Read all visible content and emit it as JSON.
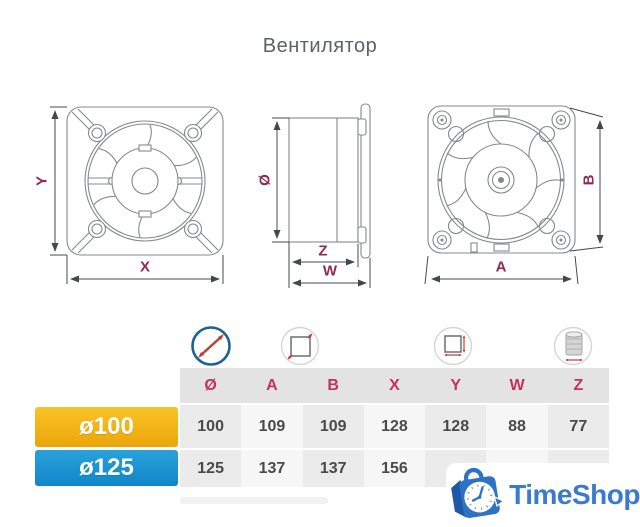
{
  "title": "Вентилятор",
  "drawings": {
    "front_view": {
      "dim_y": "Y",
      "dim_x": "X"
    },
    "side_view": {
      "dim_diameter": "Ø",
      "dim_z": "Z",
      "dim_w": "W"
    },
    "back_view": {
      "dim_b": "B",
      "dim_a": "A"
    }
  },
  "table": {
    "icon_names": [
      "diameter-icon",
      "panel-size-icon",
      "duct-panel-size-icon",
      "duct-depth-icon"
    ],
    "columns": [
      "Ø",
      "A",
      "B",
      "X",
      "Y",
      "W",
      "Z"
    ],
    "rows": [
      {
        "label": "ø100",
        "values": [
          "100",
          "109",
          "109",
          "128",
          "128",
          "88",
          "77"
        ]
      },
      {
        "label": "ø125",
        "values": [
          "125",
          "137",
          "137",
          "156",
          "",
          "",
          ""
        ]
      }
    ]
  },
  "logo": {
    "text": "TimeShop"
  },
  "colors": {
    "title_text": "#5d6266",
    "header_text": "#c5315f",
    "dim_label_text": "#8f2b52",
    "row_100_bg": "#f2b014",
    "row_125_bg": "#1a94d2",
    "header_bg": "#e3e3e3",
    "cell_dark": "#ebebeb",
    "cell_light": "#f6f6f6",
    "logo_blue": "#3b7ad3",
    "diameter_icon_ring": "#1c6391",
    "dim_arrow_red": "#c23b2e"
  }
}
